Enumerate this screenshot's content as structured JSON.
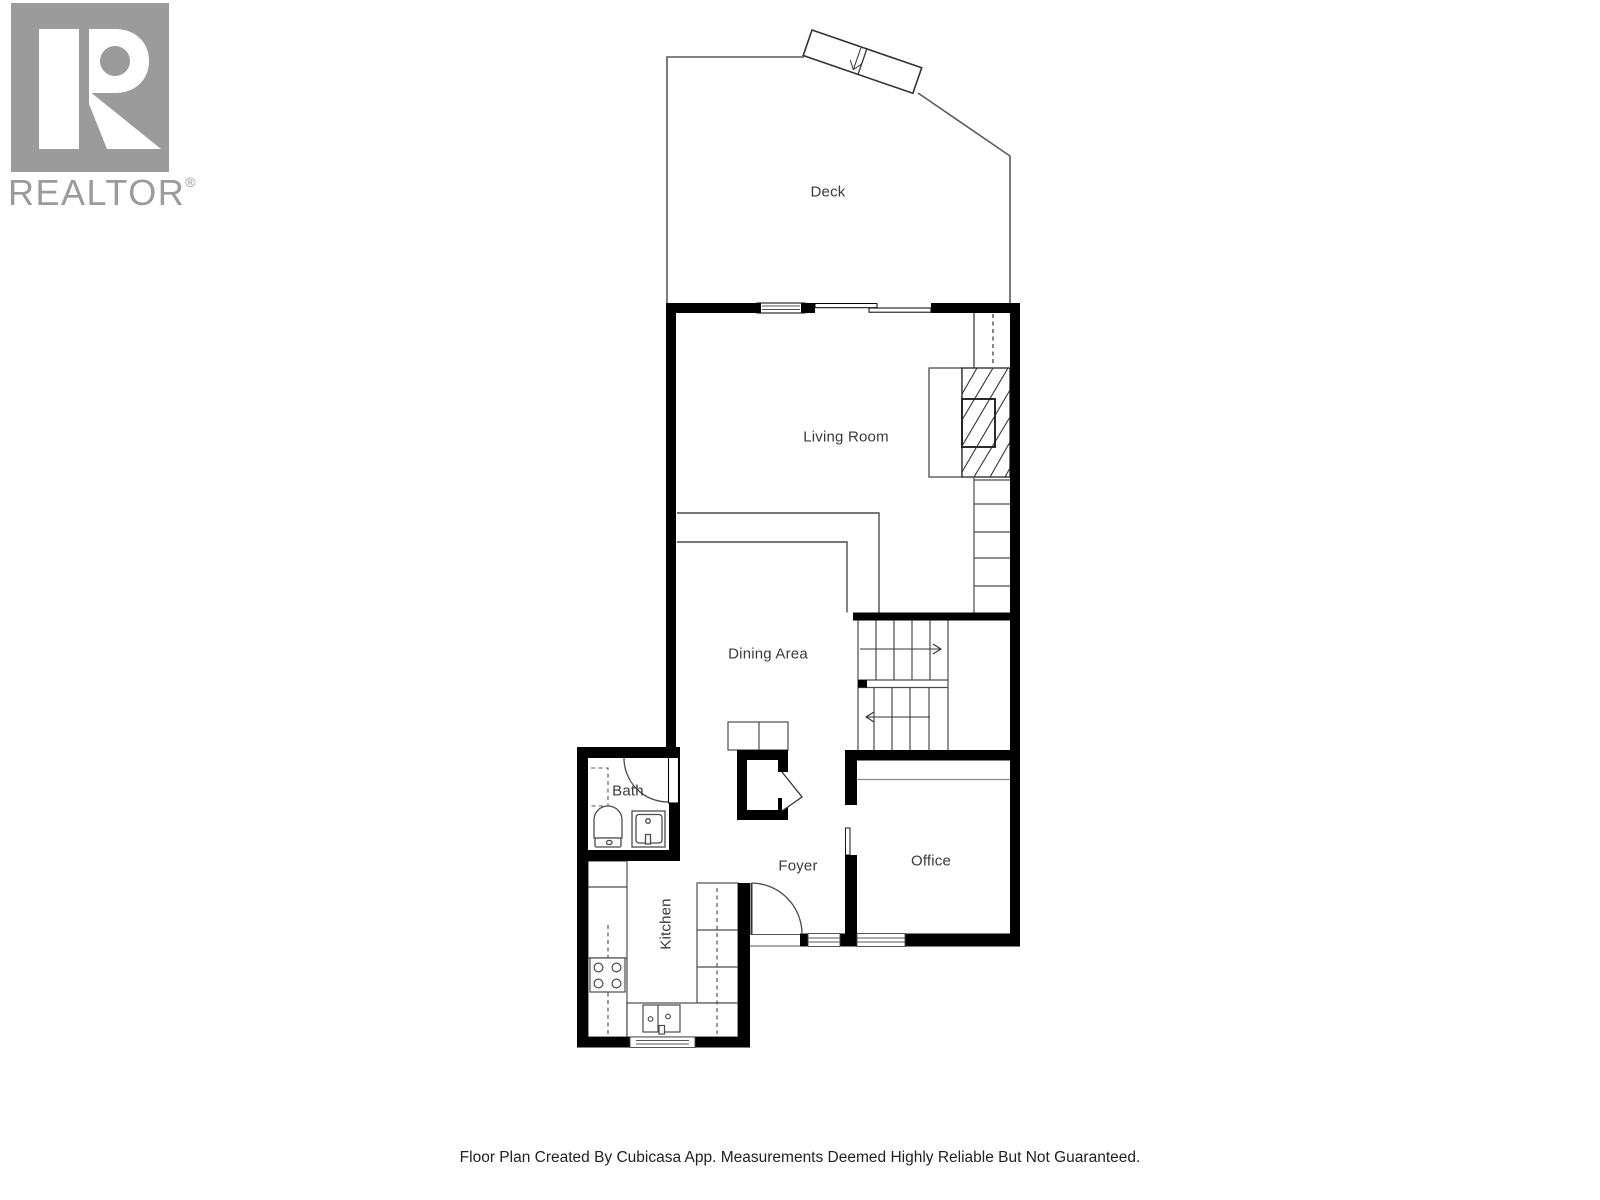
{
  "branding": {
    "name": "REALTOR",
    "registered_mark": "®",
    "logo_icon": "realtor-r-logo",
    "logo_color": "#9b9b9b"
  },
  "floor_plan": {
    "rooms": {
      "deck": {
        "label": "Deck"
      },
      "living_room": {
        "label": "Living Room"
      },
      "dining_area": {
        "label": "Dining Area"
      },
      "bath": {
        "label": "Bath"
      },
      "foyer": {
        "label": "Foyer"
      },
      "kitchen": {
        "label": "Kitchen"
      },
      "office": {
        "label": "Office"
      }
    },
    "colors": {
      "wall": "#000000",
      "line": "#4c4c4c",
      "label_text": "#3a3a3a"
    }
  },
  "footer": {
    "caption": "Floor Plan Created By Cubicasa App. Measurements Deemed Highly Reliable But Not Guaranteed."
  }
}
